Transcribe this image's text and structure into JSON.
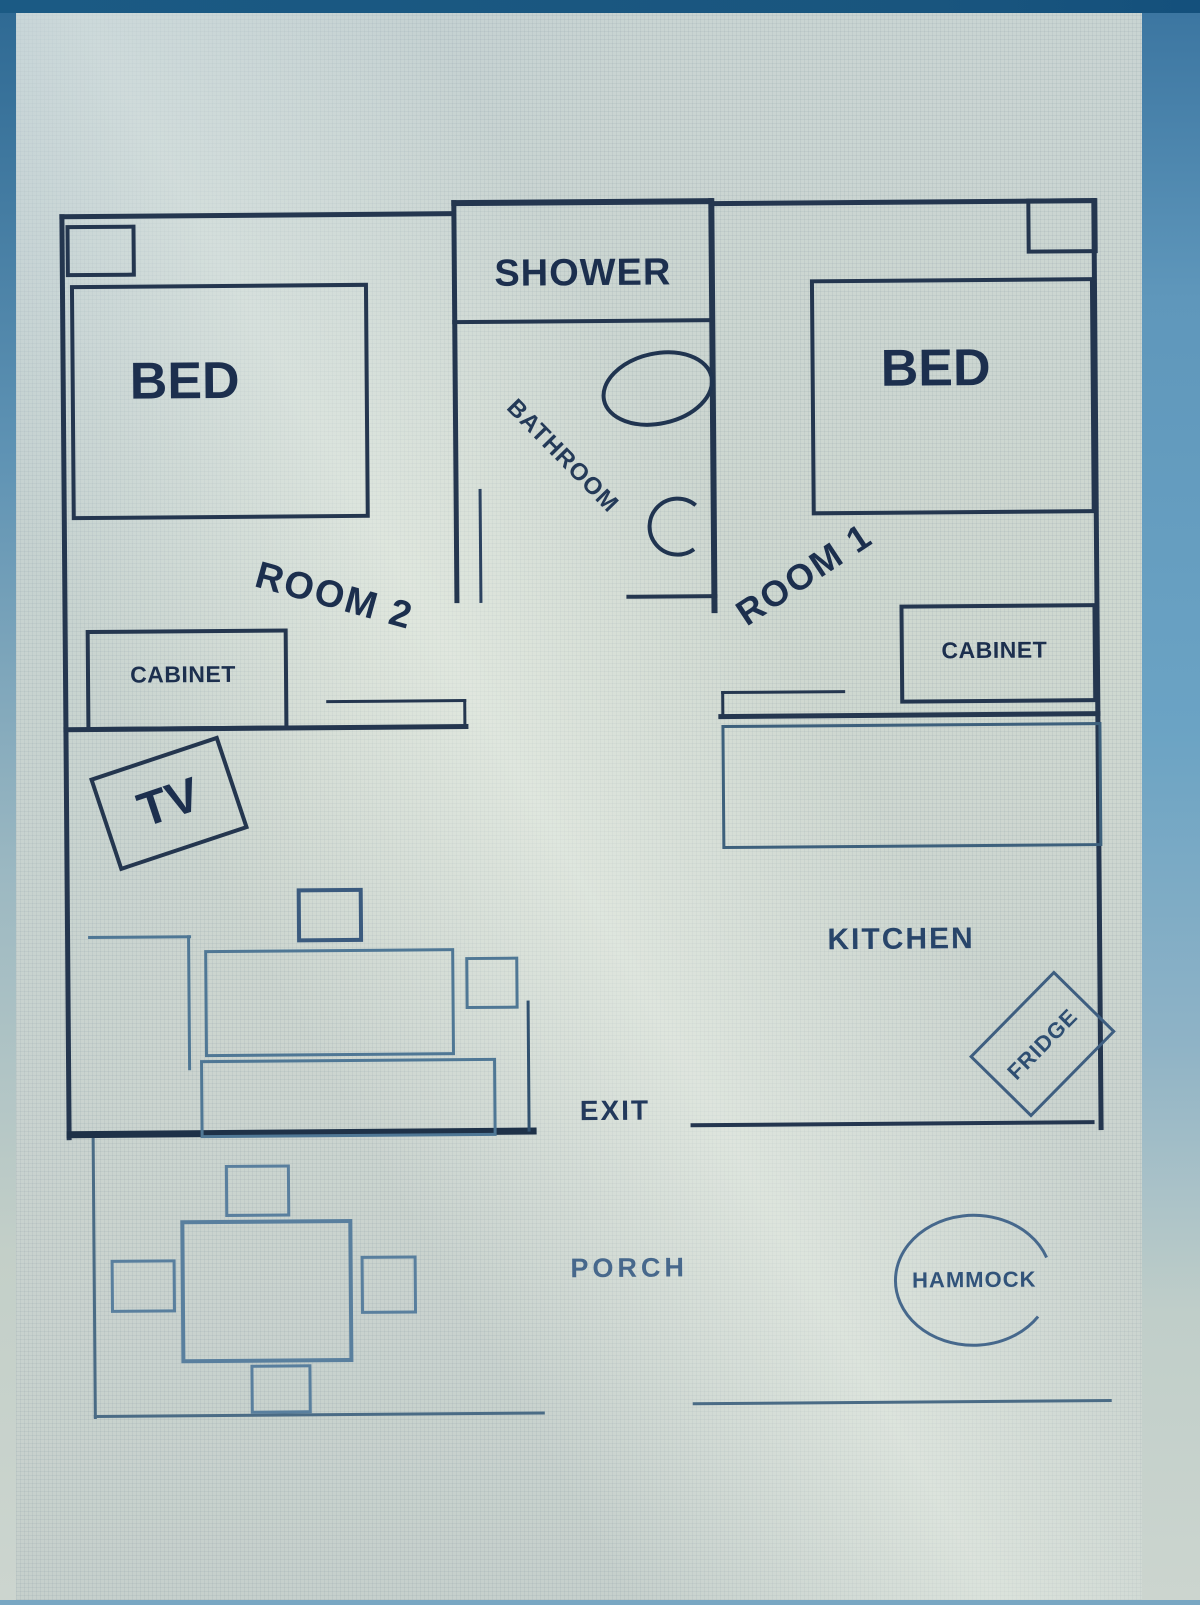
{
  "scene": {
    "description": "Photo of a hand-drafted floor plan shown on a blue computer screen",
    "colors": {
      "screen_blue": "#79a7c3",
      "top_bar": "#19557e",
      "paper": "#cdd6d1",
      "wall": "#24364f",
      "light_furniture": "#4f7795",
      "text": "#1c2f4e"
    }
  },
  "floor_plan": {
    "rooms": [
      {
        "name": "ROOM 2",
        "furniture": [
          "BED",
          "CABINET",
          "TV"
        ]
      },
      {
        "name": "BATHROOM",
        "furniture": [
          "SHOWER"
        ]
      },
      {
        "name": "ROOM 1",
        "furniture": [
          "BED",
          "CABINET"
        ]
      },
      {
        "name": "KITCHEN",
        "furniture": [
          "FRIDGE"
        ]
      },
      {
        "name": "PORCH",
        "furniture": [
          "HAMMOCK"
        ]
      }
    ],
    "labels": {
      "shower": "SHOWER",
      "bathroom": "BATHROOM",
      "bed_left": "BED",
      "bed_right": "BED",
      "room2": "ROOM 2",
      "room1": "ROOM 1",
      "cabinet_left": "CABINET",
      "cabinet_right": "CABINET",
      "tv": "TV",
      "kitchen": "KITCHEN",
      "fridge": "FRIDGE",
      "exit": "EXIT",
      "porch": "PORCH",
      "hammock": "HAMMOCK"
    }
  }
}
